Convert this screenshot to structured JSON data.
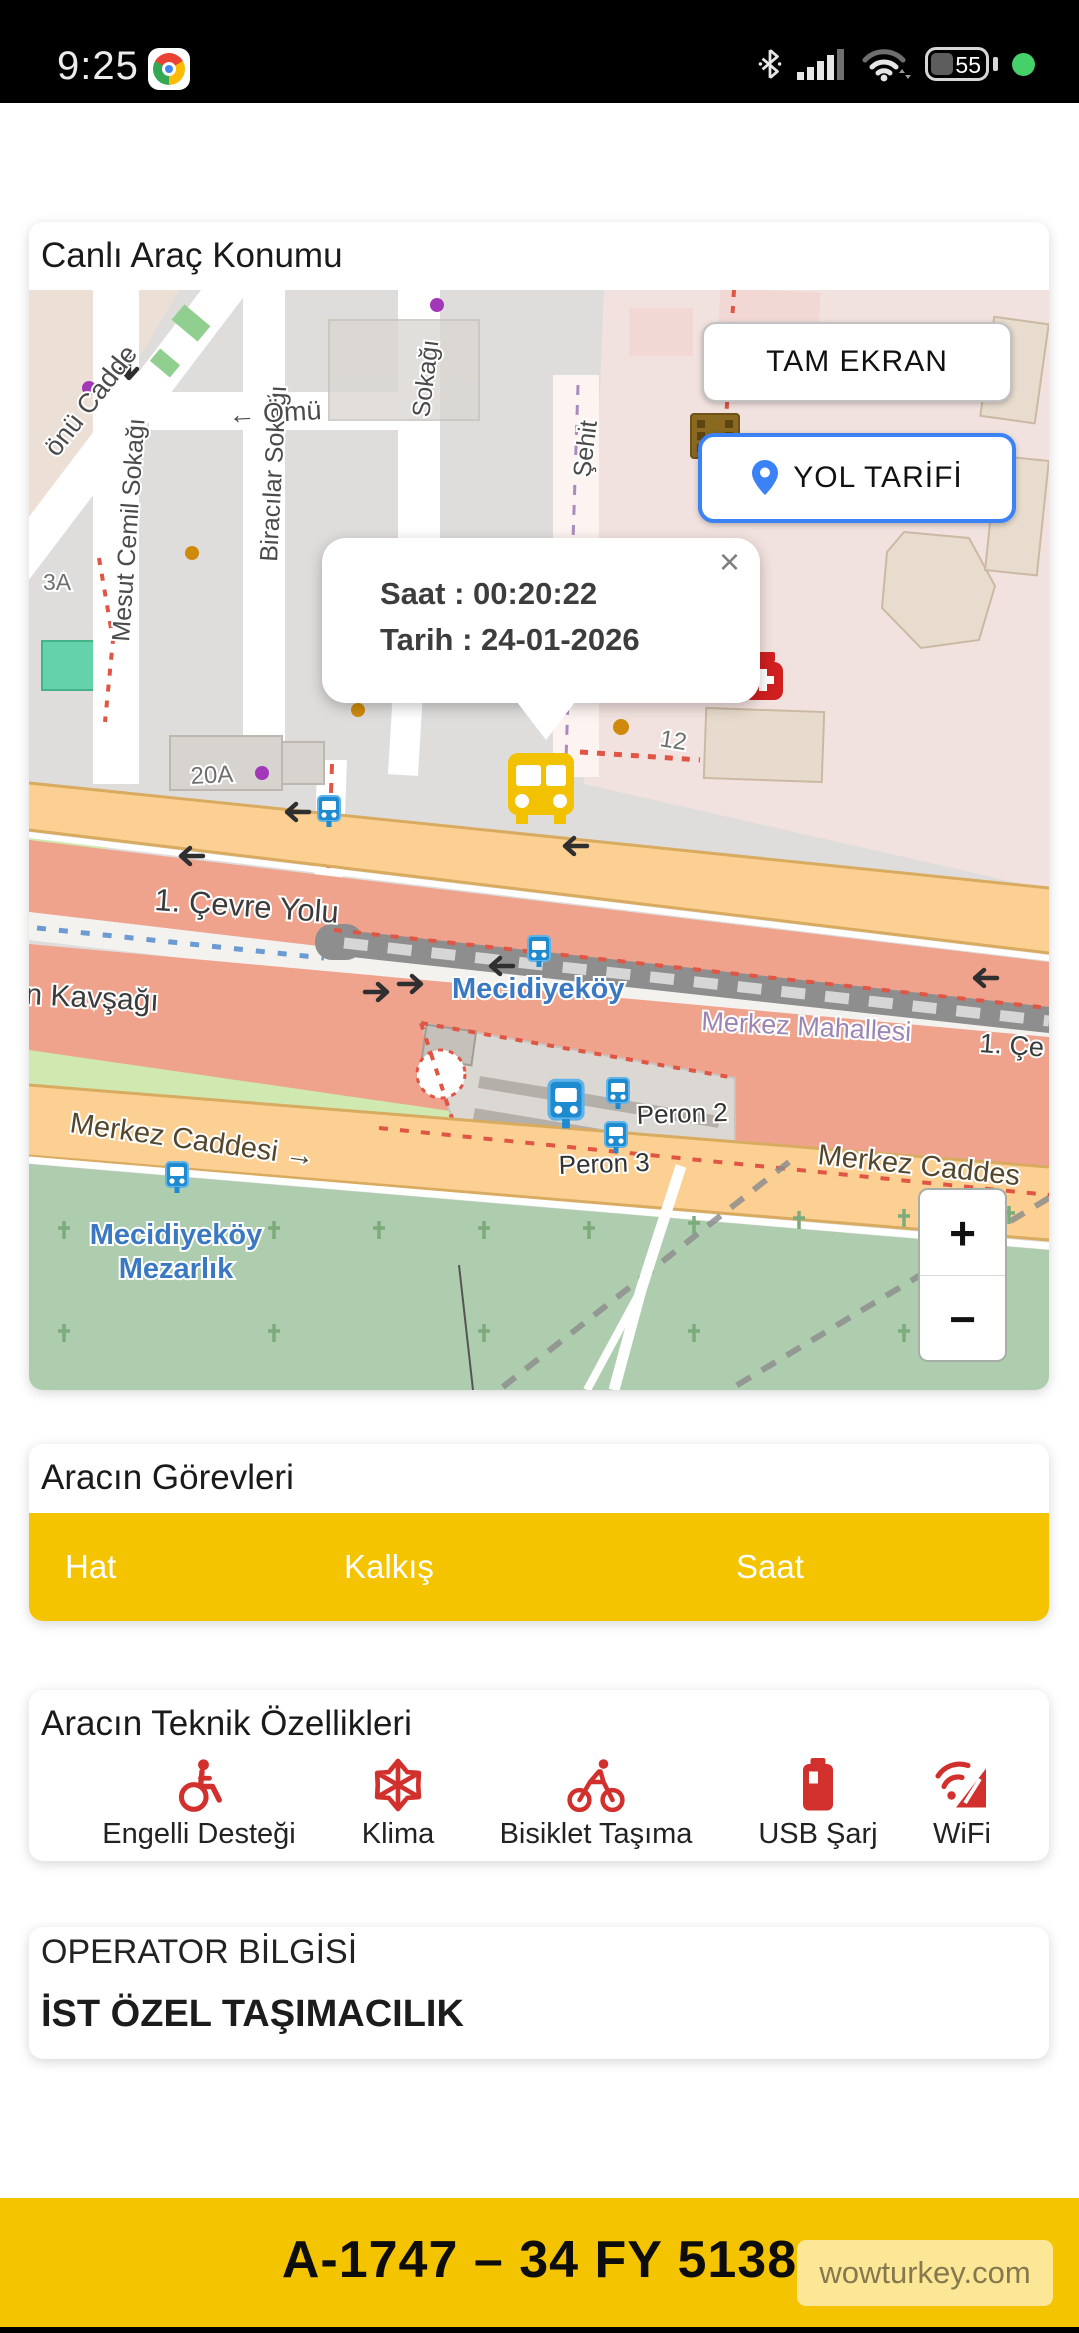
{
  "status_bar": {
    "time": "9:25",
    "battery_level": "55"
  },
  "live_card": {
    "title": "Canlı Araç Konumu",
    "fullscreen_button": "TAM EKRAN",
    "directions_button": "YOL TARİFİ",
    "popup": {
      "time": "Saat : 00:20:22",
      "date": "Tarih : 24-01-2026",
      "close": "×"
    },
    "zoom_in": "+",
    "zoom_out": "−",
    "map_labels": {
      "onu_cadde": "önü Cadde",
      "mesut": "Mesut Cemil Sokağı",
      "biracilar": "Biracılar Sokağı",
      "sokagi": "Sokağı",
      "omu": "← Ömü",
      "sehit": "Şehit",
      "b3a": "3A",
      "b20a": "20A",
      "b12": "12",
      "cevre_yolu": "1. Çevre Yolu",
      "kavsagi": "n Kavşağı",
      "mecidiyekoy": "Mecidiyeköy",
      "merkez_mahallesi": "Merkez Mahallesi",
      "cevre_short": "1. Çe",
      "merkez_caddesi_left": "Merkez Caddesi →",
      "merkez_caddesi_right": "Merkez Caddes",
      "peron2": "Peron 2",
      "peron3": "Peron 3",
      "mezarlik_line1": "Mecidiyeköy",
      "mezarlik_line2": "Mezarlık"
    }
  },
  "tasks_card": {
    "title": "Aracın Görevleri",
    "columns": [
      "Hat",
      "Kalkış",
      "Saat"
    ],
    "rows": []
  },
  "features_card": {
    "title": "Aracın Teknik Özellikleri",
    "items": [
      {
        "icon": "wheelchair-icon",
        "label": "Engelli Desteği"
      },
      {
        "icon": "snowflake-icon",
        "label": "Klima"
      },
      {
        "icon": "bicycle-icon",
        "label": "Bisiklet Taşıma"
      },
      {
        "icon": "battery-icon",
        "label": "USB Şarj"
      },
      {
        "icon": "wifi-icon",
        "label": "WiFi"
      }
    ]
  },
  "operator_card": {
    "title": "OPERATOR BİLGİSİ",
    "value": "İST ÖZEL TAŞIMACILIK"
  },
  "footer": {
    "plate": "A-1747 – 34 FY 5138",
    "watermark": "wowturkey.com"
  },
  "colors": {
    "accent_yellow": "#F5C400",
    "feature_red": "#D2302C",
    "directions_blue": "#3B82F6",
    "bus_marker_yellow": "#F2C200"
  }
}
